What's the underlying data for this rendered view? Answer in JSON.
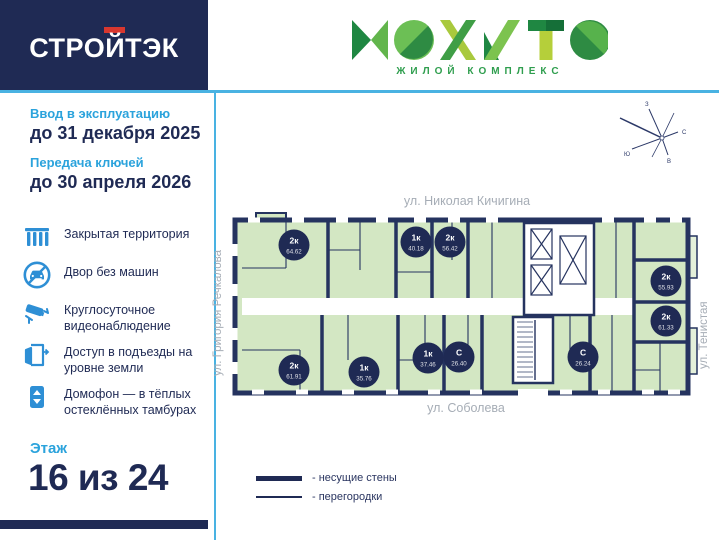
{
  "brand": {
    "developer": "СТРОЙТЭК",
    "complex_logo": "МОХИТО",
    "complex_subtitle": "ЖИЛОЙ КОМПЛЕКС"
  },
  "sidebar": {
    "commissioning_label": "Ввод в эксплуатацию",
    "commissioning_date": "до 31 декабря 2025",
    "keys_label": "Передача ключей",
    "keys_date": "до 30 апреля 2026",
    "features": [
      {
        "icon": "fence-icon",
        "text": "Закрытая территория"
      },
      {
        "icon": "no-car-icon",
        "text": "Двор без машин"
      },
      {
        "icon": "cctv-icon",
        "text": "Круглосуточное видеонаблюдение"
      },
      {
        "icon": "door-icon",
        "text": "Доступ в подъезды на уровне земли"
      },
      {
        "icon": "intercom-icon",
        "text": "Домофон — в тёплых остеклённых тамбурах"
      }
    ],
    "floor_label": "Этаж",
    "floor_value": "16 из 24"
  },
  "plan": {
    "streets": {
      "top": "ул. Николая Кичигина",
      "bottom": "ул. Соболева",
      "left": "ул. Григория Речкалова",
      "right": "ул. Тенистая"
    },
    "compass": {
      "north": "С",
      "south": "Ю",
      "west": "З",
      "east": "В"
    },
    "units": [
      {
        "type": "2к",
        "area": "64.62",
        "x": 64,
        "y": 35
      },
      {
        "type": "1к",
        "area": "40.18",
        "x": 186,
        "y": 32
      },
      {
        "type": "2к",
        "area": "56.42",
        "x": 220,
        "y": 32
      },
      {
        "type": "2к",
        "area": "55.93",
        "x": 436,
        "y": 71
      },
      {
        "type": "2к",
        "area": "61.33",
        "x": 436,
        "y": 111
      },
      {
        "type": "2к",
        "area": "61.91",
        "x": 64,
        "y": 160
      },
      {
        "type": "1к",
        "area": "35.76",
        "x": 134,
        "y": 162
      },
      {
        "type": "1к",
        "area": "37.46",
        "x": 198,
        "y": 148
      },
      {
        "type": "С",
        "area": "26.40",
        "x": 229,
        "y": 147
      },
      {
        "type": "С",
        "area": "26.24",
        "x": 353,
        "y": 147
      }
    ],
    "legend": [
      {
        "style": "thick",
        "label": "- несущие стены"
      },
      {
        "style": "thin",
        "label": "- перегородки"
      }
    ]
  },
  "colors": {
    "navy": "#1f2a54",
    "accent_red": "#d8372f",
    "accent_blue": "#2ba3dc",
    "icon_blue": "#2e8fd5",
    "room_green": "#d3e7c3",
    "wall_navy": "#25335f",
    "logo_green_dark": "#1f8742",
    "logo_green_light": "#7cc34f",
    "street_gray": "#a6adb6"
  }
}
